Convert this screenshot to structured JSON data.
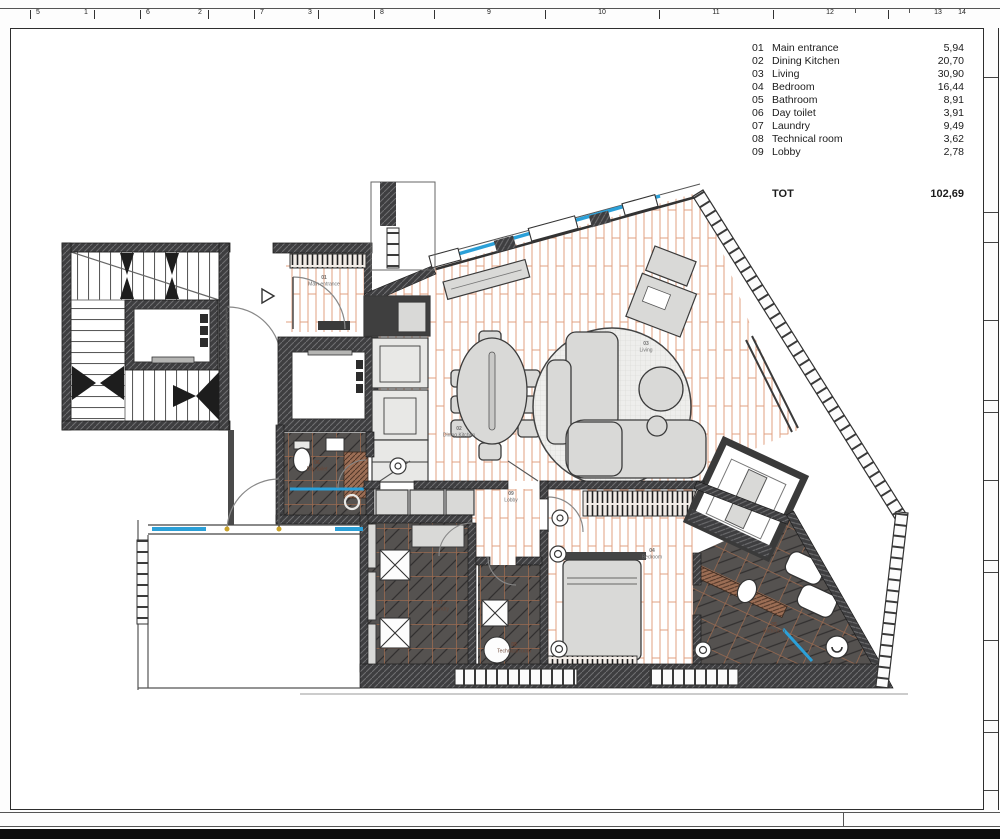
{
  "ruler": {
    "ticks": [
      {
        "t": "|",
        "x": 30
      },
      {
        "t": "5",
        "x": 38
      },
      {
        "t": "1",
        "x": 86
      },
      {
        "t": "|",
        "x": 94
      },
      {
        "t": "|",
        "x": 140
      },
      {
        "t": "6",
        "x": 148
      },
      {
        "t": "2",
        "x": 200
      },
      {
        "t": "|",
        "x": 208
      },
      {
        "t": "|",
        "x": 254
      },
      {
        "t": "7",
        "x": 262
      },
      {
        "t": "3",
        "x": 310
      },
      {
        "t": "|",
        "x": 318
      },
      {
        "t": "|",
        "x": 374
      },
      {
        "t": "8",
        "x": 382
      },
      {
        "t": "|",
        "x": 434
      },
      {
        "t": "9",
        "x": 489
      },
      {
        "t": "|",
        "x": 545
      },
      {
        "t": "10",
        "x": 602
      },
      {
        "t": "|",
        "x": 659
      },
      {
        "t": "11",
        "x": 716
      },
      {
        "t": "|",
        "x": 773
      },
      {
        "t": "12",
        "x": 830
      },
      {
        "t": "'",
        "x": 855
      },
      {
        "t": "'",
        "x": 909
      },
      {
        "t": "|",
        "x": 888
      },
      {
        "t": "13",
        "x": 938
      },
      {
        "t": "14",
        "x": 962
      }
    ]
  },
  "legend": {
    "rows": [
      {
        "no": "01",
        "name": "Main entrance",
        "area": "5,94"
      },
      {
        "no": "02",
        "name": "Dining Kitchen",
        "area": "20,70"
      },
      {
        "no": "03",
        "name": "Living",
        "area": "30,90"
      },
      {
        "no": "04",
        "name": "Bedroom",
        "area": "16,44"
      },
      {
        "no": "05",
        "name": "Bathroom",
        "area": "8,91"
      },
      {
        "no": "06",
        "name": "Day toilet",
        "area": "3,91"
      },
      {
        "no": "07",
        "name": "Laundry",
        "area": "9,49"
      },
      {
        "no": "08",
        "name": "Technical room",
        "area": "3,62"
      },
      {
        "no": "09",
        "name": "Lobby",
        "area": "2,78"
      }
    ],
    "total_label": "TOT",
    "total_value": "102,69"
  },
  "plan": {
    "room_labels": [
      {
        "no": "01",
        "name": "Main entrance",
        "x": 324,
        "y": 279,
        "tone": "light"
      },
      {
        "no": "02",
        "name": "Dining Kitchen",
        "x": 459,
        "y": 430,
        "tone": "light"
      },
      {
        "no": "03",
        "name": "Living",
        "x": 646,
        "y": 345,
        "tone": "light"
      },
      {
        "no": "04",
        "name": "Bedroom",
        "x": 652,
        "y": 552,
        "tone": "light"
      },
      {
        "no": "05",
        "name": "Bathroom",
        "x": 774,
        "y": 626,
        "tone": "dark"
      },
      {
        "no": "06",
        "name": "Day toilet",
        "x": 317,
        "y": 464,
        "tone": "dark"
      },
      {
        "no": "07",
        "name": "Laundry",
        "x": 440,
        "y": 604,
        "tone": "dark"
      },
      {
        "no": "08",
        "name": "Technical room",
        "x": 514,
        "y": 646,
        "tone": "dark"
      },
      {
        "no": "09",
        "name": "Lobby",
        "x": 511,
        "y": 495,
        "tone": "light"
      }
    ]
  },
  "colors": {
    "glass_blue": "#2ba0d8",
    "wood_line": "#e0a182",
    "wall_dark": "#3e3e40",
    "furniture_gray": "#d9d9d7",
    "grout_brown": "#9a6a50",
    "hinge_gold": "#c9a22a"
  }
}
